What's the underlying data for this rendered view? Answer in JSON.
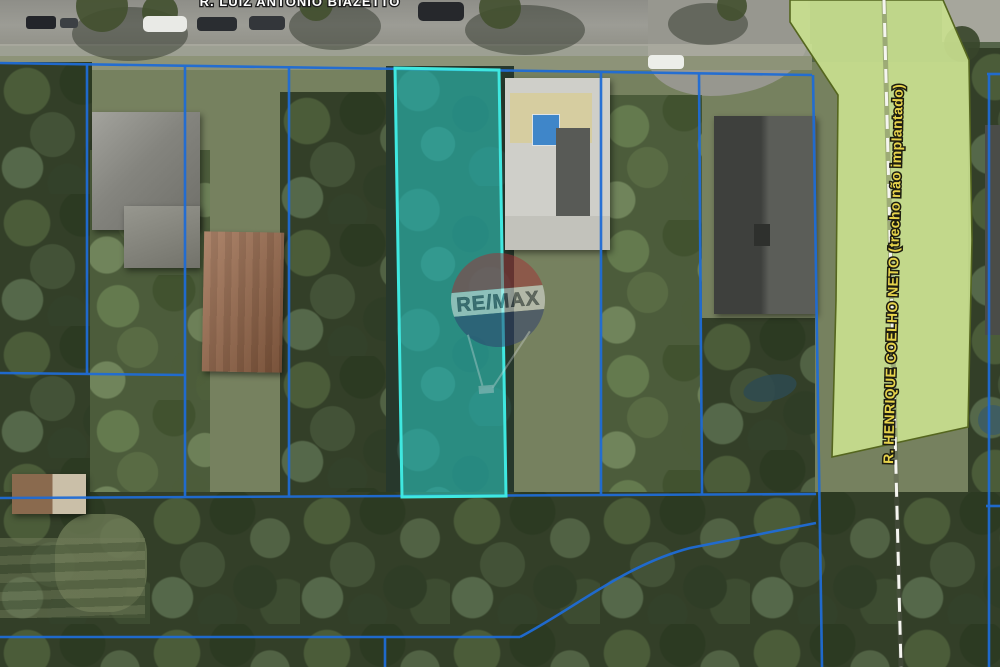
{
  "page": {
    "type": "aerial-satellite-lot-map"
  },
  "labels": {
    "street_top": "R. LUIZ ANTONIO BIAZETTO",
    "road_right": "R. HENRIQUE COELHO NETO (trecho não implantado)",
    "watermark": "RE/MAX"
  },
  "colors": {
    "lot_boundary": "#1f6cd5",
    "highlight_lot_fill": "rgba(45,210,200,0.55)",
    "highlight_lot_border": "#3fe8e0",
    "planned_road_fill": "#c9e08f",
    "planned_road_outline": "#55661f",
    "road_label": "#e8d44c",
    "street_label": "#ffffff",
    "centerline_dash": "#f5f5f0",
    "remax_red": "#a23237",
    "remax_blue": "#2e3d6e"
  }
}
